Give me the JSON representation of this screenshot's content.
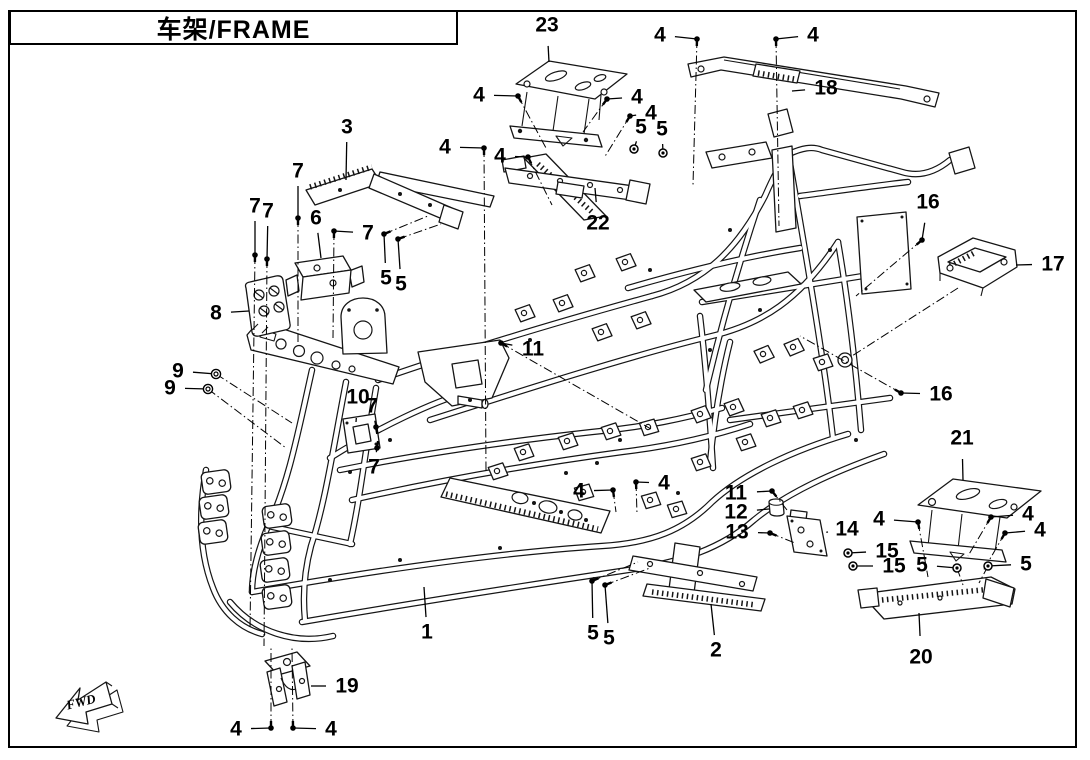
{
  "page": {
    "title": "车架/FRAME",
    "title_zh": "车架",
    "title_en": "FRAME"
  },
  "fwd_marker": {
    "label": "FWD"
  },
  "diagram": {
    "description": "Exploded parts diagram of vehicle frame",
    "part_numbers_visible": [
      "1",
      "2",
      "3",
      "4",
      "5",
      "6",
      "7",
      "8",
      "9",
      "10",
      "11",
      "12",
      "13",
      "14",
      "15",
      "16",
      "17",
      "18",
      "19",
      "20",
      "21",
      "22",
      "23"
    ],
    "line_color": "#151515",
    "callouts": [
      {
        "label": "23",
        "x": 547,
        "y": 25,
        "tx": 549,
        "ty": 62,
        "glyph": "none"
      },
      {
        "label": "4",
        "x": 660,
        "y": 35,
        "tx": 697,
        "ty": 39,
        "glyph": "bolt",
        "ex": 693,
        "ey": 185
      },
      {
        "label": "4",
        "x": 813,
        "y": 35,
        "tx": 776,
        "ty": 39,
        "glyph": "bolt",
        "ex": 779,
        "ey": 226
      },
      {
        "label": "18",
        "x": 826,
        "y": 88,
        "tx": 792,
        "ty": 91,
        "glyph": "none"
      },
      {
        "label": "4",
        "x": 479,
        "y": 95,
        "tx": 518,
        "ty": 96,
        "glyph": "bolt",
        "ex": 546,
        "ey": 148
      },
      {
        "label": "4",
        "x": 637,
        "y": 97,
        "tx": 607,
        "ty": 99,
        "glyph": "bolt",
        "ex": 583,
        "ey": 132
      },
      {
        "label": "4",
        "x": 651,
        "y": 113,
        "tx": 630,
        "ty": 116,
        "glyph": "bolt",
        "ex": 604,
        "ey": 158
      },
      {
        "label": "5",
        "x": 641,
        "y": 127,
        "tx": 634,
        "ty": 149,
        "glyph": "nut"
      },
      {
        "label": "5",
        "x": 662,
        "y": 129,
        "tx": 663,
        "ty": 153,
        "glyph": "nut"
      },
      {
        "label": "3",
        "x": 347,
        "y": 127,
        "tx": 346,
        "ty": 180,
        "glyph": "none"
      },
      {
        "label": "4",
        "x": 445,
        "y": 147,
        "tx": 484,
        "ty": 148,
        "glyph": "bolt",
        "ex": 486,
        "ey": 472
      },
      {
        "label": "4",
        "x": 500,
        "y": 156,
        "tx": 528,
        "ty": 157,
        "glyph": "bolt",
        "ex": 552,
        "ey": 205
      },
      {
        "label": "7",
        "x": 298,
        "y": 171,
        "tx": 298,
        "ty": 218,
        "glyph": "bolt",
        "ex": 298,
        "ey": 342
      },
      {
        "label": "7",
        "x": 255,
        "y": 206,
        "tx": 255,
        "ty": 255,
        "glyph": "bolt",
        "ex": 250,
        "ey": 630
      },
      {
        "label": "7",
        "x": 268,
        "y": 211,
        "tx": 267,
        "ty": 259,
        "glyph": "bolt",
        "ex": 264,
        "ey": 646
      },
      {
        "label": "6",
        "x": 316,
        "y": 218,
        "tx": 321,
        "ty": 258,
        "glyph": "none"
      },
      {
        "label": "7",
        "x": 368,
        "y": 233,
        "tx": 334,
        "ty": 231,
        "glyph": "bolt",
        "ex": 333,
        "ey": 338
      },
      {
        "label": "22",
        "x": 598,
        "y": 223,
        "tx": 595,
        "ty": 188,
        "glyph": "none"
      },
      {
        "label": "5",
        "x": 386,
        "y": 278,
        "tx": 384,
        "ty": 234,
        "glyph": "bolt",
        "ex": 428,
        "ey": 216
      },
      {
        "label": "5",
        "x": 401,
        "y": 284,
        "tx": 398,
        "ty": 239,
        "glyph": "bolt",
        "ex": 441,
        "ey": 224
      },
      {
        "label": "16",
        "x": 928,
        "y": 202,
        "tx": 922,
        "ty": 240,
        "glyph": "bolt",
        "ex": 856,
        "ey": 296
      },
      {
        "label": "17",
        "x": 1053,
        "y": 264,
        "tx": 1016,
        "ty": 265,
        "glyph": "none"
      },
      {
        "label": "8",
        "x": 216,
        "y": 313,
        "tx": 249,
        "ty": 311,
        "glyph": "none"
      },
      {
        "label": "11",
        "x": 533,
        "y": 349,
        "tx": 501,
        "ty": 343,
        "glyph": "bolt",
        "ex": 651,
        "ey": 429
      },
      {
        "label": "9",
        "x": 178,
        "y": 371,
        "tx": 216,
        "ty": 374,
        "glyph": "washer",
        "ex": 292,
        "ey": 423
      },
      {
        "label": "9",
        "x": 170,
        "y": 388,
        "tx": 208,
        "ty": 389,
        "glyph": "washer",
        "ex": 286,
        "ey": 448
      },
      {
        "label": "10",
        "x": 358,
        "y": 397,
        "tx": 356,
        "ty": 422,
        "glyph": "none"
      },
      {
        "label": "7",
        "x": 372,
        "y": 406,
        "tx": 376,
        "ty": 427,
        "glyph": "bolt"
      },
      {
        "label": "16",
        "x": 941,
        "y": 394,
        "tx": 901,
        "ty": 393,
        "glyph": "bolt",
        "ex": 800,
        "ey": 336
      },
      {
        "label": "7",
        "x": 374,
        "y": 467,
        "tx": 377,
        "ty": 448,
        "glyph": "bolt"
      },
      {
        "label": "21",
        "x": 962,
        "y": 438,
        "tx": 963,
        "ty": 480,
        "glyph": "none"
      },
      {
        "label": "4",
        "x": 579,
        "y": 491,
        "tx": 613,
        "ty": 490,
        "glyph": "bolt",
        "ex": 616,
        "ey": 512
      },
      {
        "label": "4",
        "x": 664,
        "y": 483,
        "tx": 636,
        "ty": 482,
        "glyph": "bolt",
        "ex": 637,
        "ey": 514
      },
      {
        "label": "11",
        "x": 736,
        "y": 493,
        "tx": 772,
        "ty": 491,
        "glyph": "bolt",
        "ex": 787,
        "ey": 510
      },
      {
        "label": "12",
        "x": 736,
        "y": 512,
        "tx": 769,
        "ty": 509,
        "glyph": "none"
      },
      {
        "label": "13",
        "x": 737,
        "y": 532,
        "tx": 770,
        "ty": 533,
        "glyph": "bolt",
        "ex": 795,
        "ey": 543
      },
      {
        "label": "14",
        "x": 847,
        "y": 529,
        "tx": 828,
        "ty": 532,
        "glyph": "none"
      },
      {
        "label": "4",
        "x": 879,
        "y": 519,
        "tx": 918,
        "ty": 522,
        "glyph": "bolt",
        "ex": 928,
        "ey": 577
      },
      {
        "label": "4",
        "x": 1028,
        "y": 514,
        "tx": 991,
        "ty": 517,
        "glyph": "bolt",
        "ex": 968,
        "ey": 556
      },
      {
        "label": "4",
        "x": 1040,
        "y": 530,
        "tx": 1005,
        "ty": 533,
        "glyph": "bolt",
        "ex": 983,
        "ey": 571
      },
      {
        "label": "15",
        "x": 887,
        "y": 551,
        "tx": 848,
        "ty": 553,
        "glyph": "nut"
      },
      {
        "label": "15",
        "x": 894,
        "y": 566,
        "tx": 853,
        "ty": 566,
        "glyph": "nut"
      },
      {
        "label": "5",
        "x": 922,
        "y": 565,
        "tx": 957,
        "ty": 568,
        "glyph": "nut",
        "ex": 963,
        "ey": 585
      },
      {
        "label": "5",
        "x": 1026,
        "y": 564,
        "tx": 988,
        "ty": 566,
        "glyph": "nut",
        "ex": 979,
        "ey": 583
      },
      {
        "label": "1",
        "x": 427,
        "y": 632,
        "tx": 424,
        "ty": 587,
        "glyph": "none"
      },
      {
        "label": "5",
        "x": 593,
        "y": 633,
        "tx": 592,
        "ty": 581,
        "glyph": "bolt",
        "ex": 638,
        "ey": 562
      },
      {
        "label": "5",
        "x": 609,
        "y": 638,
        "tx": 605,
        "ty": 585,
        "glyph": "bolt",
        "ex": 650,
        "ey": 568
      },
      {
        "label": "2",
        "x": 716,
        "y": 650,
        "tx": 711,
        "ty": 604,
        "glyph": "none"
      },
      {
        "label": "20",
        "x": 921,
        "y": 657,
        "tx": 919,
        "ty": 613,
        "glyph": "none"
      },
      {
        "label": "19",
        "x": 347,
        "y": 686,
        "tx": 311,
        "ty": 686,
        "glyph": "none"
      },
      {
        "label": "4",
        "x": 236,
        "y": 729,
        "tx": 271,
        "ty": 728,
        "glyph": "bolt",
        "ex": 271,
        "ey": 648
      },
      {
        "label": "4",
        "x": 331,
        "y": 729,
        "tx": 293,
        "ty": 728,
        "glyph": "bolt",
        "ex": 292,
        "ey": 648
      }
    ]
  }
}
